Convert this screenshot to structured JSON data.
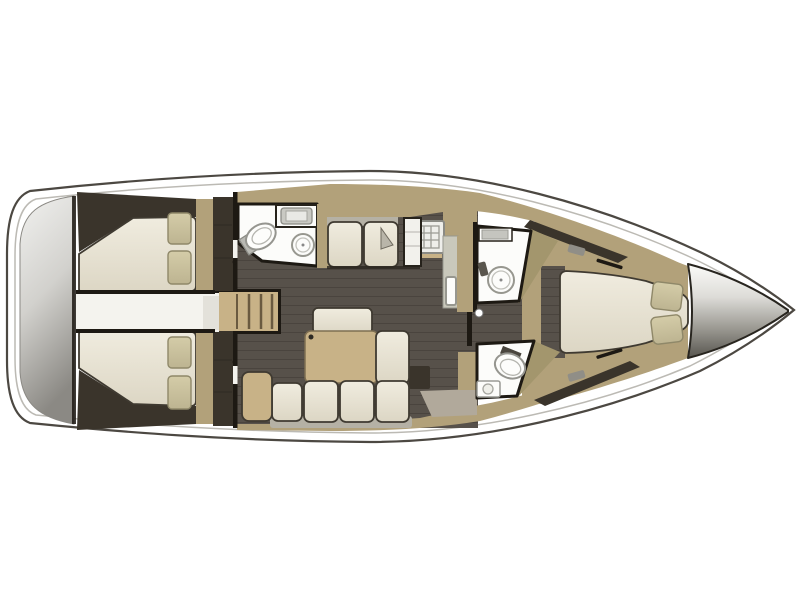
{
  "meta": {
    "title": "Sailing yacht interior layout plan, top view: three double cabins, saloon, galley and three wet rooms",
    "view": "overhead floor plan",
    "orientation": "bow to the right, stern to the left"
  },
  "palette": {
    "bg": "#ffffff",
    "hull_outline": "#4c4842",
    "deck_inner_line": "#bcbab4",
    "floor": "#57514a",
    "floor_plank": "#454039",
    "wood": "#b2a17a",
    "wood_light": "#c8b287",
    "wood_dark": "#a3966d",
    "walls_dark": "#3a342b",
    "bulkhead_black": "#1d1913",
    "cushion": "#ece8da",
    "cushion_outline": "#3f3a31",
    "pillow": "#ccc39d",
    "pillow_border": "#8f8869",
    "backrest_grey": "#b5b1a5",
    "counter": "#c9c8bb",
    "bath_floor": "#fcfcfa",
    "fixture_grey": "#97978f",
    "fixture_inner": "#c2c2bc",
    "hatch_grey": "#908e87",
    "floor_patch": "#b1a99b",
    "metal_light": "#f2f1ef",
    "metal_mid": "#c9c7c2",
    "metal_dark": "#83817b"
  },
  "areas": [
    {
      "id": "transom",
      "label": "Stern swim platform"
    },
    {
      "id": "aft-cabin-port",
      "label": "Aft double cabin, port side, with two pillows"
    },
    {
      "id": "aft-cabin-starboard",
      "label": "Aft double cabin, starboard side, with two pillows"
    },
    {
      "id": "engine-corridor",
      "label": "Center passage between aft cabins"
    },
    {
      "id": "companionway",
      "label": "Companionway steps"
    },
    {
      "id": "aft-head",
      "label": "Aft head with toilet, vanity and round washbasin"
    },
    {
      "id": "saloon",
      "label": "Saloon with settee, folding table, bench and L-shaped sofa"
    },
    {
      "id": "galley",
      "label": "Galley with stove and sink counter"
    },
    {
      "id": "shower-room",
      "label": "Midship shower room with round shower tray"
    },
    {
      "id": "forward-head",
      "label": "Forward head with toilet and washbasin"
    },
    {
      "id": "forward-cabin",
      "label": "Forward double cabin with island berth and two pillows"
    },
    {
      "id": "anchor-locker",
      "label": "Bow anchor locker"
    }
  ],
  "furniture_counts": {
    "double_berths": 3,
    "pillows_total": 6,
    "settee_cushions": 2,
    "sofa_seat_cushions": 4,
    "sofa_chaise_cushions": 1,
    "bench_cushions": 1,
    "toilets": 2,
    "washbasins": 4,
    "shower_trays": 1,
    "stoves": 1,
    "companionway_steps": 4
  }
}
